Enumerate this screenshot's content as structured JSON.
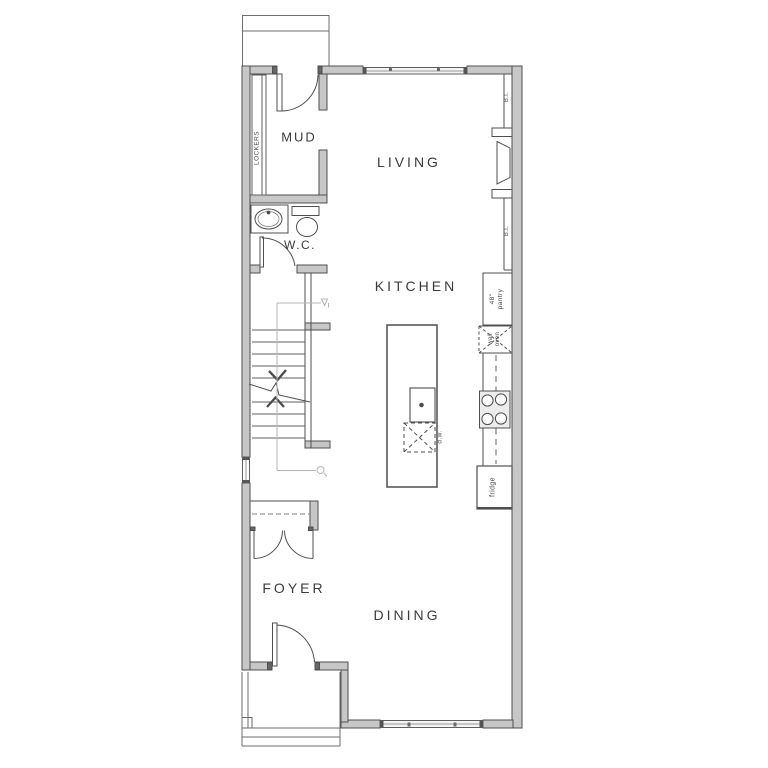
{
  "labels": {
    "living": "LIVING",
    "kitchen": "KITCHEN",
    "dining": "DINING",
    "foyer": "FOYER",
    "mud": "MUD",
    "wc": "W.C.",
    "lockers": "LOCKERS",
    "bi_upper": "B.I.",
    "bi_lower": "B.I.",
    "pantry_line1": "48\"",
    "pantry_line2": "pantry",
    "oven_line1": "wall",
    "oven_line2": "oven",
    "fridge": "fridge",
    "dishwasher": "d.w."
  },
  "colors": {
    "wall_fill": "#c7c7c7",
    "wall_line": "#4f4f4f",
    "thin_line": "#5f5f5f",
    "text": "#3b3b3b",
    "guide": "#b4b4b4",
    "window_fill": "#f4f4f4"
  }
}
